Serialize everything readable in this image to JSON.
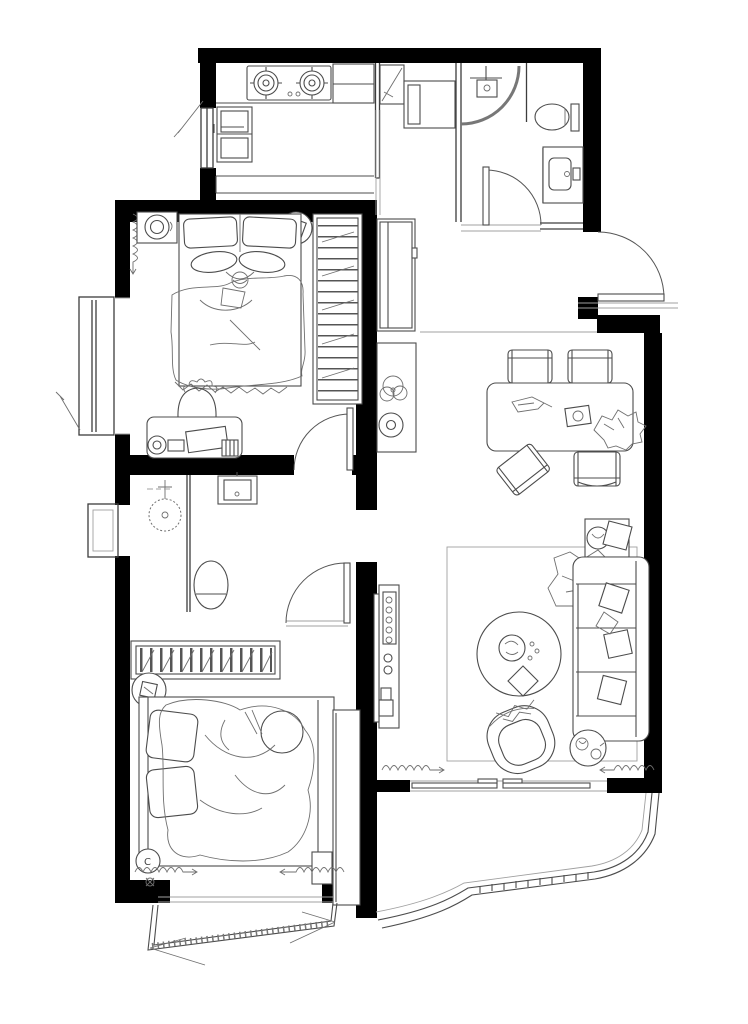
{
  "meta": {
    "type": "architectural-floor-plan",
    "units_shown": false,
    "scale_shown": false
  },
  "palette": {
    "wall": "#000000",
    "partition": "#3d3d3d",
    "furniture": "#4c4c4c",
    "sketch": "#6f6f6f",
    "background": "#ffffff"
  },
  "labels": {
    "closet_marker": "C"
  },
  "rooms": [
    {
      "id": "kitchen",
      "features": [
        "two-burner-stove",
        "refrigerator",
        "counter",
        "tall-cabinet",
        "window-west"
      ]
    },
    {
      "id": "bathroom-top",
      "features": [
        "corner-shower",
        "toilet",
        "vanity-sink",
        "swing-door"
      ]
    },
    {
      "id": "entry-hall",
      "features": [
        "tall-cabinet",
        "storage-box",
        "hall-wardrobe",
        "decor-shelf",
        "entry-door"
      ]
    },
    {
      "id": "bedroom-top",
      "features": [
        "double-bed",
        "pillows",
        "nightstand",
        "pendant-decor",
        "wardrobe",
        "desk",
        "desk-chair",
        "bay-window",
        "curtain",
        "swing-door"
      ]
    },
    {
      "id": "bathroom-middle",
      "features": [
        "shower-head",
        "washbasin-unit",
        "toilet",
        "swing-door",
        "window-west",
        "louver-radiator"
      ]
    },
    {
      "id": "bedroom-bottom",
      "features": [
        "double-bed-occupied",
        "pillows",
        "stool",
        "closet-marker-c",
        "dresser",
        "bay-window",
        "curtains"
      ]
    },
    {
      "id": "living-dining",
      "features": [
        "dining-table",
        "four-chairs",
        "sofa",
        "throw-blanket",
        "cushions",
        "coffee-table",
        "armchair",
        "side-table",
        "plant-table",
        "tv-console",
        "rug",
        "curtains",
        "sliding-door"
      ]
    },
    {
      "id": "balcony",
      "features": [
        "curved-glazing",
        "railing"
      ]
    }
  ]
}
